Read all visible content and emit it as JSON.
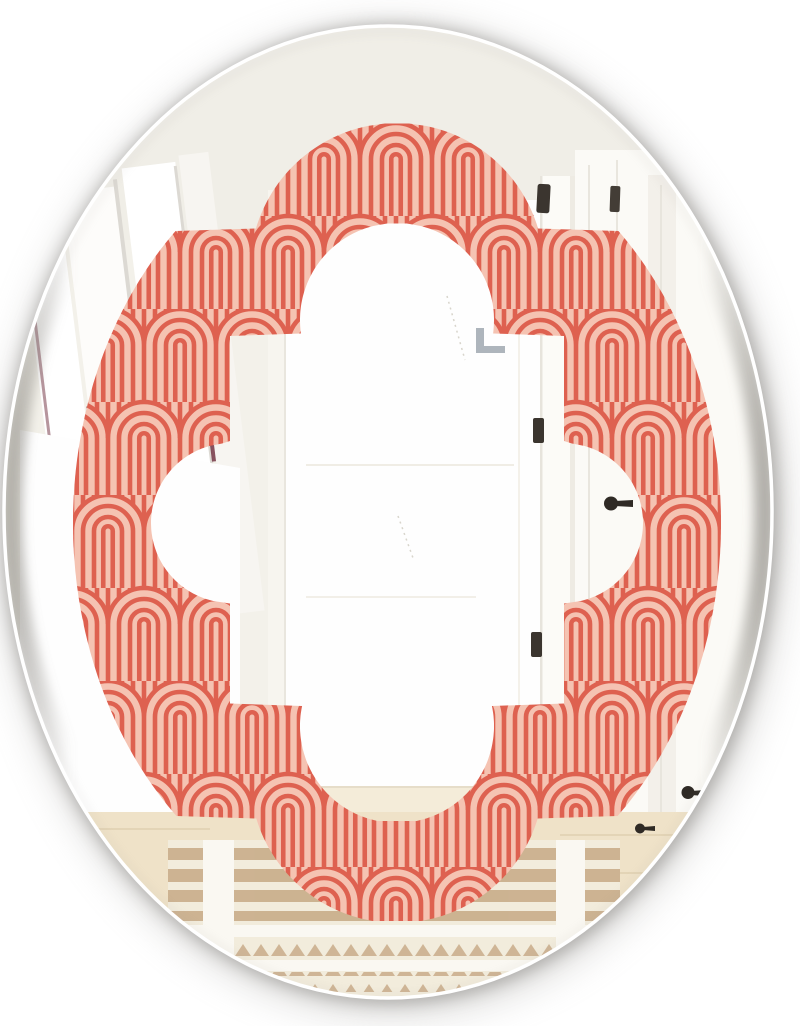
{
  "image": {
    "type": "product-photo",
    "subject": "oval wall mirror with art-deco quatrefoil printed frame",
    "setting": "mirror reflecting a white hallway interior"
  },
  "colors": {
    "page_bg": "#ffffff",
    "pattern_pink": "#f5c3b2",
    "pattern_red": "#de6150",
    "wall_base": "#f3f1ea",
    "wall_upper": "#f0eee7",
    "bright_white": "#fefefe",
    "trim_line": "#e9e6de",
    "maroon_accent": "#6d2b3c",
    "bracket_gray": "#aeb5bc",
    "hinge_dark": "#3b352f",
    "hook_dark": "#2f2a25",
    "wood_floor": "#efe2c8",
    "wood_line": "#e3d4b6",
    "door_floor": "#f4ecd9",
    "rug_cream": "#f2ecdc",
    "rug_tan": "#cbb08e",
    "rug_white": "#faf8f2",
    "rim_gray": "#8d8a84",
    "shadow_gray": "#7e7c78"
  },
  "scene": {
    "mirror_shape": "oval",
    "frame_shape": "quatrefoil",
    "frame_pattern": "art-deco nested arches",
    "reflection_elements": [
      "white picture frames on left wall",
      "open white door with dark hinges",
      "door hinges near top",
      "coat hooks on right wall",
      "metal bracket",
      "wood floor",
      "striped tan and cream rug with triangle motifs"
    ]
  },
  "pattern_spec": {
    "tile_width": 72,
    "tile_height": 186,
    "arch_radius": 36,
    "arc_radii": [
      36,
      25,
      14,
      7
    ],
    "line_width": 4.6,
    "row_stagger": 93
  }
}
